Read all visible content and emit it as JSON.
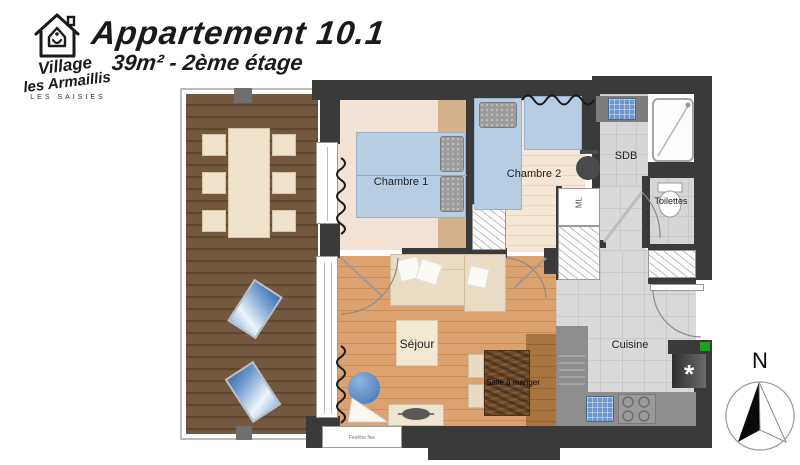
{
  "branding": {
    "name_line1": "Village",
    "name_line2": "les Armaillis",
    "location": "LES SAISIES"
  },
  "header": {
    "title": "Appartement 10.1",
    "subtitle": "39m² - 2ème étage"
  },
  "labels": {
    "chambre1": "Chambre 1",
    "chambre2": "Chambre 2",
    "sdb": "SDB",
    "toilettes": "Toilettes",
    "ml": "ML",
    "sejour": "Séjour",
    "salle_a_manger": "Salle à manger",
    "cuisine": "Cuisine",
    "window_note": "Fenêtre fixe",
    "storage_marker": "*",
    "north": "N"
  },
  "colors": {
    "wall": "#3a3a3a",
    "terrace_wood": "#6f5740",
    "sejour_wood": "#d89f6b",
    "pale_wood": "#f6e6d6",
    "bed_blue": "#b7cde3",
    "tile_gray": "#d9d9d9",
    "counter_gray": "#8d8d8d",
    "accent_green": "#1fa01f",
    "text": "#1a1a1a"
  }
}
